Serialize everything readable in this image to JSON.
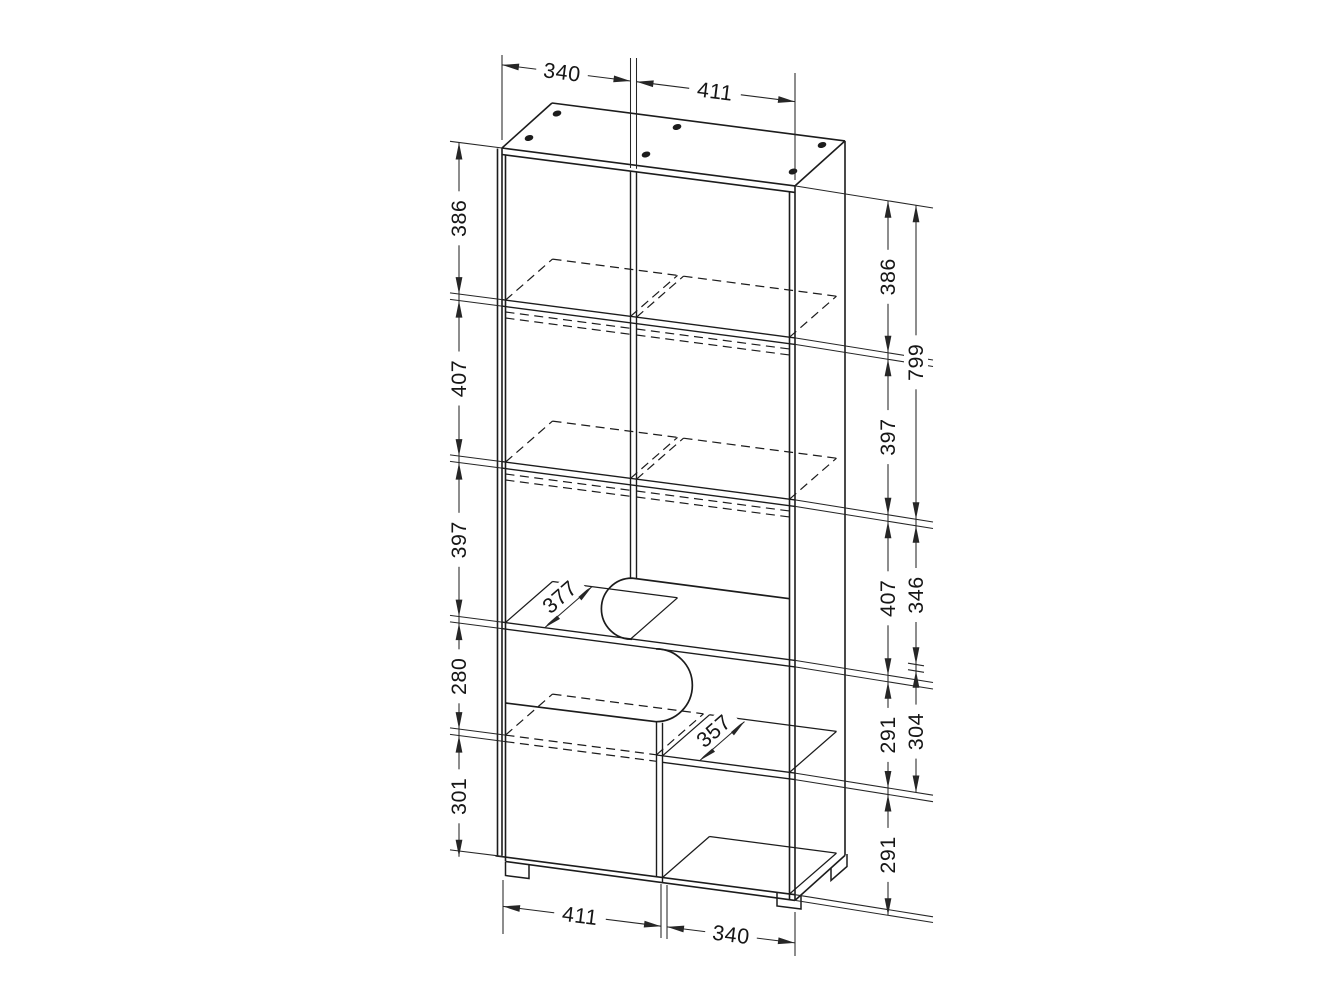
{
  "drawing": {
    "kind": "furniture cabinet dimensional diagram",
    "background": "#ffffff",
    "line_color": "#1c1c1c"
  },
  "dimensions": {
    "top": [
      {
        "value": "340"
      },
      {
        "value": "411"
      }
    ],
    "bottom": [
      {
        "value": "411"
      },
      {
        "value": "340"
      }
    ],
    "left_column": [
      {
        "value": "386"
      },
      {
        "value": "407"
      },
      {
        "value": "397"
      },
      {
        "value": "280"
      },
      {
        "value": "301"
      }
    ],
    "right_inner_column": [
      {
        "value": "386"
      },
      {
        "value": "397"
      },
      {
        "value": "407"
      },
      {
        "value": "291"
      },
      {
        "value": "291"
      }
    ],
    "right_outer_column": [
      {
        "value": "799"
      },
      {
        "value": "346"
      },
      {
        "value": "304"
      }
    ],
    "depth": [
      {
        "value": "377"
      },
      {
        "value": "357"
      }
    ]
  }
}
